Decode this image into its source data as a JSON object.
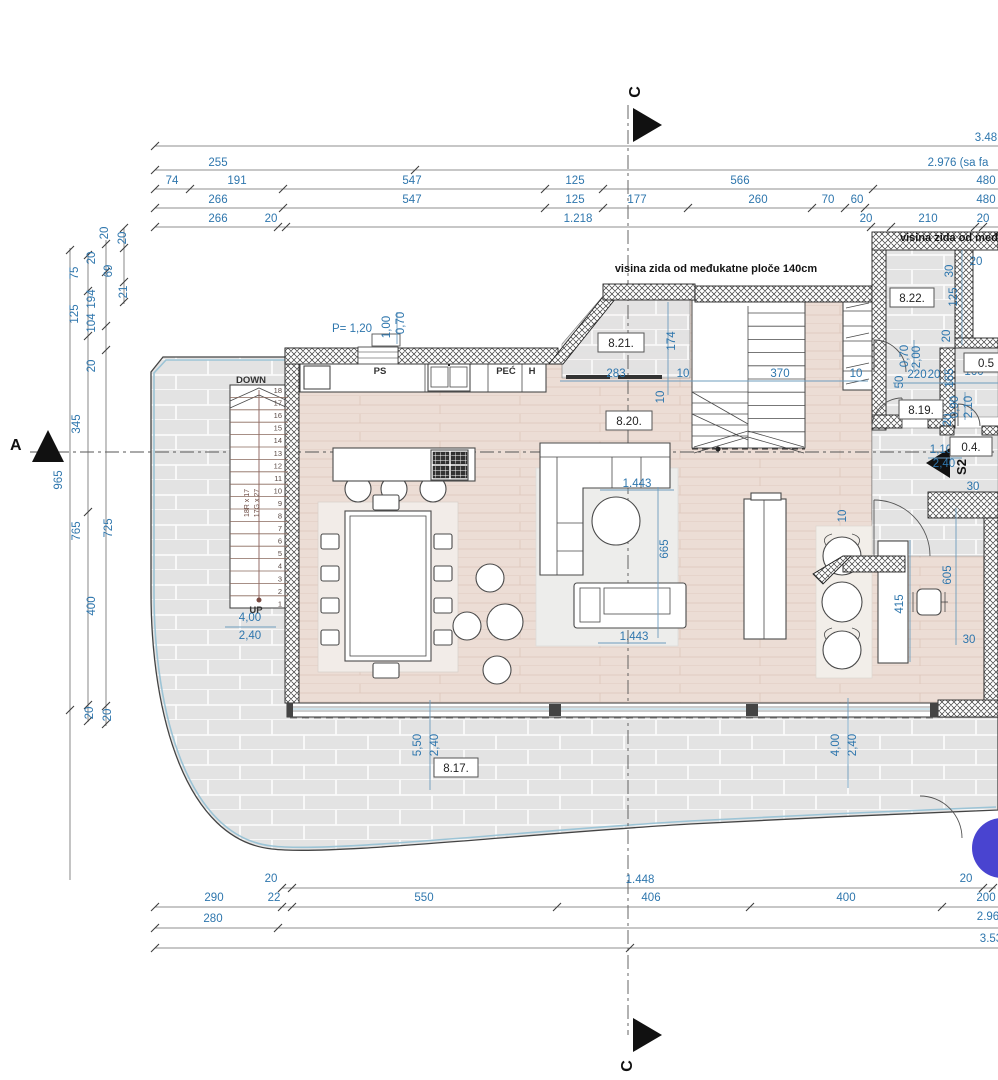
{
  "colors": {
    "dim_blue": "#2e76ad",
    "line_dark": "#333333",
    "wood_floor": "#ecddd5",
    "tile_gray": "#e3e3e3",
    "accent_circle": "#4944d0",
    "glass_blue": "#9cc4d6"
  },
  "annotations": {
    "wall_height_center": "visina zida od međukatne ploče 140cm",
    "wall_height_right": "visina zida od međukatne ploče 140cm"
  },
  "section_markers": {
    "a": "A",
    "c_top": "C",
    "c_bottom": "C",
    "s2": "S2"
  },
  "rooms": [
    {
      "id": "8.21.",
      "x": 621,
      "y": 343,
      "w": 46
    },
    {
      "id": "8.20.",
      "x": 629,
      "y": 421,
      "w": 46
    },
    {
      "id": "8.22.",
      "x": 912,
      "y": 298,
      "w": 44
    },
    {
      "id": "8.19.",
      "x": 921,
      "y": 410,
      "w": 44
    },
    {
      "id": "8.17.",
      "x": 456,
      "y": 768,
      "w": 44
    },
    {
      "id": "0.4.",
      "x": 971,
      "y": 447,
      "w": 42
    },
    {
      "id": "0.5",
      "x": 986,
      "y": 363,
      "w": 44
    }
  ],
  "stairs": {
    "down_label": "DOWN",
    "up_label": "UP",
    "steps": [
      "18",
      "17",
      "16",
      "15",
      "14",
      "13",
      "12",
      "11",
      "10",
      "9",
      "8",
      "7",
      "6",
      "5",
      "4",
      "3",
      "2",
      "1"
    ]
  },
  "labels": [
    {
      "t": "3.48",
      "x": 986,
      "y": 141
    },
    {
      "t": "255",
      "x": 218,
      "y": 166
    },
    {
      "t": "2.976 (sa fa",
      "x": 958,
      "y": 166
    },
    {
      "t": "74",
      "x": 172,
      "y": 184
    },
    {
      "t": "191",
      "x": 237,
      "y": 184
    },
    {
      "t": "547",
      "x": 412,
      "y": 184
    },
    {
      "t": "125",
      "x": 575,
      "y": 184
    },
    {
      "t": "566",
      "x": 740,
      "y": 184
    },
    {
      "t": "480",
      "x": 986,
      "y": 184
    },
    {
      "t": "266",
      "x": 218,
      "y": 203
    },
    {
      "t": "547",
      "x": 412,
      "y": 203
    },
    {
      "t": "125",
      "x": 575,
      "y": 203
    },
    {
      "t": "177",
      "x": 637,
      "y": 203
    },
    {
      "t": "260",
      "x": 758,
      "y": 203
    },
    {
      "t": "70",
      "x": 828,
      "y": 203
    },
    {
      "t": "60",
      "x": 857,
      "y": 203
    },
    {
      "t": "480",
      "x": 986,
      "y": 203
    },
    {
      "t": "266",
      "x": 218,
      "y": 222
    },
    {
      "t": "20",
      "x": 271,
      "y": 222
    },
    {
      "t": "1.218",
      "x": 578,
      "y": 222
    },
    {
      "t": "20",
      "x": 866,
      "y": 222
    },
    {
      "t": "210",
      "x": 928,
      "y": 222
    },
    {
      "t": "20",
      "x": 983,
      "y": 222
    },
    {
      "t": "20",
      "x": 108,
      "y": 233,
      "r": 1
    },
    {
      "t": "20",
      "x": 126,
      "y": 238,
      "r": 1
    },
    {
      "t": "75",
      "x": 78,
      "y": 273,
      "r": 1
    },
    {
      "t": "69",
      "x": 112,
      "y": 271,
      "r": 1
    },
    {
      "t": "21",
      "x": 127,
      "y": 292,
      "r": 1
    },
    {
      "t": "20",
      "x": 95,
      "y": 258,
      "r": 1
    },
    {
      "t": "194",
      "x": 95,
      "y": 299,
      "r": 1
    },
    {
      "t": "104",
      "x": 95,
      "y": 323,
      "r": 1
    },
    {
      "t": "125",
      "x": 78,
      "y": 314,
      "r": 1
    },
    {
      "t": "20",
      "x": 95,
      "y": 366,
      "r": 1
    },
    {
      "t": "345",
      "x": 80,
      "y": 424,
      "r": 1
    },
    {
      "t": "965",
      "x": 62,
      "y": 480,
      "r": 1
    },
    {
      "t": "765",
      "x": 80,
      "y": 531,
      "r": 1
    },
    {
      "t": "725",
      "x": 112,
      "y": 528,
      "r": 1
    },
    {
      "t": "400",
      "x": 95,
      "y": 606,
      "r": 1
    },
    {
      "t": "20",
      "x": 93,
      "y": 713,
      "r": 1
    },
    {
      "t": "20",
      "x": 111,
      "y": 715,
      "r": 1
    },
    {
      "t": "20",
      "x": 271,
      "y": 882
    },
    {
      "t": "1.448",
      "x": 640,
      "y": 883
    },
    {
      "t": "20",
      "x": 966,
      "y": 882
    },
    {
      "t": "290",
      "x": 214,
      "y": 901
    },
    {
      "t": "22",
      "x": 274,
      "y": 901
    },
    {
      "t": "550",
      "x": 424,
      "y": 901
    },
    {
      "t": "406",
      "x": 651,
      "y": 901
    },
    {
      "t": "400",
      "x": 846,
      "y": 901
    },
    {
      "t": "200",
      "x": 986,
      "y": 901
    },
    {
      "t": "280",
      "x": 213,
      "y": 922
    },
    {
      "t": "2.96",
      "x": 988,
      "y": 920
    },
    {
      "t": "3.53",
      "x": 991,
      "y": 942
    },
    {
      "t": "283",
      "x": 616,
      "y": 377
    },
    {
      "t": "10",
      "x": 683,
      "y": 377
    },
    {
      "t": "370",
      "x": 780,
      "y": 377
    },
    {
      "t": "174",
      "x": 675,
      "y": 341,
      "r": 1
    },
    {
      "t": "10",
      "x": 664,
      "y": 397,
      "r": 1
    },
    {
      "t": "1.443",
      "x": 637,
      "y": 487
    },
    {
      "t": "665",
      "x": 668,
      "y": 549,
      "r": 1
    },
    {
      "t": "1.443",
      "x": 634,
      "y": 640
    },
    {
      "t": "10",
      "x": 846,
      "y": 516,
      "r": 1
    },
    {
      "t": "605",
      "x": 951,
      "y": 575,
      "r": 1
    },
    {
      "t": "415",
      "x": 903,
      "y": 604,
      "r": 1
    },
    {
      "t": "30",
      "x": 969,
      "y": 643
    },
    {
      "t": "5,50",
      "x": 421,
      "y": 745,
      "r": 1
    },
    {
      "t": "2,40",
      "x": 438,
      "y": 745,
      "r": 1
    },
    {
      "t": "4,00",
      "x": 839,
      "y": 745,
      "r": 1
    },
    {
      "t": "2,40",
      "x": 856,
      "y": 745,
      "r": 1
    },
    {
      "t": "4,00",
      "x": 250,
      "y": 621
    },
    {
      "t": "2,40",
      "x": 250,
      "y": 639
    },
    {
      "t": "P= 1,20",
      "x": 352,
      "y": 332
    },
    {
      "t": "1,00",
      "x": 390,
      "y": 327,
      "r": 1
    },
    {
      "t": "0,70",
      "x": 404,
      "y": 323,
      "r": 1
    },
    {
      "t": "30",
      "x": 953,
      "y": 271,
      "r": 1
    },
    {
      "t": "20",
      "x": 976,
      "y": 265
    },
    {
      "t": "125",
      "x": 957,
      "y": 297,
      "r": 1
    },
    {
      "t": "20",
      "x": 950,
      "y": 336,
      "r": 1
    },
    {
      "t": "10",
      "x": 856,
      "y": 377
    },
    {
      "t": "50",
      "x": 903,
      "y": 382,
      "r": 1
    },
    {
      "t": "220",
      "x": 917,
      "y": 378
    },
    {
      "t": "20",
      "x": 934,
      "y": 378
    },
    {
      "t": "165",
      "x": 953,
      "y": 378,
      "r": 1
    },
    {
      "t": "160",
      "x": 974,
      "y": 375
    },
    {
      "t": "0,70",
      "x": 908,
      "y": 356,
      "r": 1
    },
    {
      "t": "2,00",
      "x": 920,
      "y": 357,
      "r": 1
    },
    {
      "t": "0,90",
      "x": 958,
      "y": 407,
      "r": 1
    },
    {
      "t": "2,10",
      "x": 972,
      "y": 407,
      "r": 1
    },
    {
      "t": "1,10",
      "x": 941,
      "y": 453
    },
    {
      "t": "2,40",
      "x": 944,
      "y": 467
    },
    {
      "t": "30",
      "x": 973,
      "y": 490
    },
    {
      "t": "20",
      "x": 951,
      "y": 420,
      "r": 1
    },
    {
      "t": "PS",
      "x": 380,
      "y": 374,
      "s": "d"
    },
    {
      "t": "PEĆ",
      "x": 506,
      "y": 374,
      "s": "d"
    },
    {
      "t": "H",
      "x": 532,
      "y": 374,
      "s": "d"
    },
    {
      "t": "DOWN",
      "x": 251,
      "y": 383,
      "s": "d"
    },
    {
      "t": "UP",
      "x": 256,
      "y": 613,
      "s": "d"
    },
    {
      "t": "18R x 17",
      "x": 249,
      "y": 503,
      "r": 1,
      "s": "st"
    },
    {
      "t": "17G x 27",
      "x": 259,
      "y": 503,
      "r": 1,
      "s": "st"
    }
  ],
  "dim_lines": {
    "h": [
      {
        "y": 146,
        "x1": 155,
        "x2": 998,
        "ticks": [
          155
        ]
      },
      {
        "y": 170,
        "x1": 155,
        "x2": 998,
        "ticks": [
          155,
          415
        ]
      },
      {
        "y": 189,
        "x1": 155,
        "x2": 998,
        "ticks": [
          155,
          190,
          283,
          545,
          603,
          873
        ]
      },
      {
        "y": 208,
        "x1": 155,
        "x2": 998,
        "ticks": [
          155,
          283,
          545,
          603,
          688,
          812,
          845,
          865
        ]
      },
      {
        "y": 227,
        "x1": 155,
        "x2": 998,
        "ticks": [
          155,
          278,
          286,
          871,
          891,
          975,
          983
        ]
      },
      {
        "y": 888,
        "x1": 282,
        "x2": 996,
        "ticks": [
          282,
          292,
          983,
          993
        ]
      },
      {
        "y": 907,
        "x1": 155,
        "x2": 998,
        "ticks": [
          155,
          282,
          292,
          557,
          750,
          942
        ]
      },
      {
        "y": 928,
        "x1": 155,
        "x2": 998,
        "ticks": [
          155,
          278
        ]
      },
      {
        "y": 948,
        "x1": 155,
        "x2": 998,
        "ticks": [
          155,
          630
        ]
      }
    ],
    "v": [
      {
        "x": 70,
        "y1": 248,
        "y2": 880,
        "ticks": [
          250,
          710
        ]
      },
      {
        "x": 88,
        "y1": 253,
        "y2": 722,
        "ticks": [
          255,
          291,
          336,
          512,
          705,
          721
        ]
      },
      {
        "x": 106,
        "y1": 240,
        "y2": 726,
        "ticks": [
          244,
          272,
          326,
          350,
          706,
          724
        ]
      },
      {
        "x": 124,
        "y1": 228,
        "y2": 304,
        "ticks": [
          228,
          248,
          282,
          302
        ]
      }
    ]
  },
  "blue_lines": [
    {
      "x1": 560,
      "y1": 381,
      "x2": 868,
      "y2": 381
    },
    {
      "x1": 893,
      "y1": 383,
      "x2": 998,
      "y2": 383
    },
    {
      "x1": 668,
      "y1": 302,
      "x2": 668,
      "y2": 395
    },
    {
      "x1": 658,
      "y1": 487,
      "x2": 658,
      "y2": 638
    },
    {
      "x1": 956,
      "y1": 508,
      "x2": 956,
      "y2": 645
    },
    {
      "x1": 910,
      "y1": 540,
      "x2": 910,
      "y2": 662
    },
    {
      "x1": 430,
      "y1": 700,
      "x2": 430,
      "y2": 790
    },
    {
      "x1": 848,
      "y1": 698,
      "x2": 848,
      "y2": 788
    },
    {
      "x1": 600,
      "y1": 490,
      "x2": 674,
      "y2": 490
    },
    {
      "x1": 598,
      "y1": 643,
      "x2": 666,
      "y2": 643
    },
    {
      "x1": 225,
      "y1": 627,
      "x2": 276,
      "y2": 627
    },
    {
      "x1": 397,
      "y1": 312,
      "x2": 397,
      "y2": 344
    },
    {
      "x1": 914,
      "y1": 340,
      "x2": 914,
      "y2": 372
    },
    {
      "x1": 965,
      "y1": 392,
      "x2": 965,
      "y2": 420
    },
    {
      "x1": 928,
      "y1": 458,
      "x2": 962,
      "y2": 458
    },
    {
      "x1": 962,
      "y1": 250,
      "x2": 962,
      "y2": 345
    }
  ]
}
